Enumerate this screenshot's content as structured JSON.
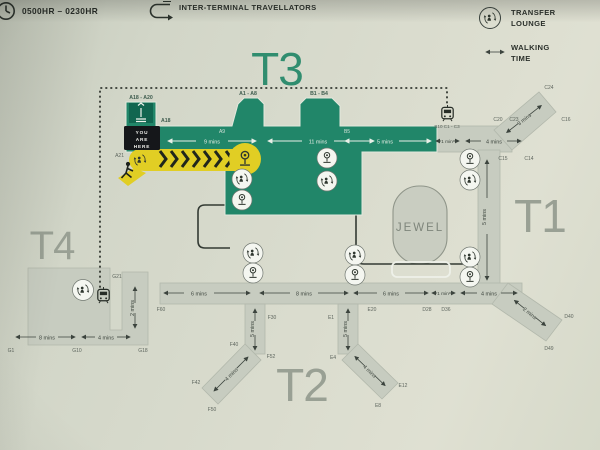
{
  "legend": {
    "operating_hours": "0500HR – 0230HR",
    "travellators_label": "INTER-TERMINAL TRAVELLATORS",
    "transfer_line1": "TRANSFER",
    "transfer_line2": "LOUNGE",
    "walking_line1": "WALKING",
    "walking_line2": "TIME"
  },
  "terminals": {
    "t3": "T3",
    "t1": "T1",
    "t2": "T2",
    "t4": "T4",
    "jewel": "JEWEL"
  },
  "marker": {
    "line1": "YOU",
    "line2": "ARE",
    "line3": "HERE"
  },
  "times": {
    "t3_seg1": "9 mins",
    "t3_seg2": "11 mins",
    "t3_seg3": "5 mins",
    "t1_link": "1 min",
    "t1_top": "4 mins",
    "t1_diag": "3 mins",
    "t1_pier": "5 mins",
    "t2_seg1": "6 mins",
    "t2_seg2": "8 mins",
    "t2_seg3": "6 mins",
    "t1_low_link": "1 min",
    "t1_low": "4 mins",
    "t1_low_diag": "2 mins",
    "t2_branch_left": "5 mins",
    "t2_branch_right": "5 mins",
    "t2_diag_left": "4 mins",
    "t2_diag_right": "4 mins",
    "t4_seg1": "8 mins",
    "t4_seg2": "4 mins",
    "t4_link": "2 mins"
  },
  "gates": {
    "a18_a20": "A18 - A20",
    "a18": "A18",
    "a21": "A21",
    "a1_a8": "A1 - A8",
    "b1_b4": "B1 - B4",
    "a9": "A9",
    "b5": "B5",
    "b10_c1c3": "B10  C1 - C3",
    "c24": "C24",
    "c20": "C20",
    "c23": "C23",
    "c16": "C16",
    "c15": "C15",
    "c14": "C14",
    "d28": "D28",
    "d36": "D36",
    "d40": "D40",
    "d49": "D49",
    "f60": "F60",
    "f30": "F30",
    "f40": "F40",
    "f52": "F52",
    "f42": "F42",
    "f50": "F50",
    "e1": "E1",
    "e20": "E20",
    "e4": "E4",
    "e12": "E12",
    "e8": "E8",
    "g1": "G1",
    "g10": "G10",
    "g18": "G18",
    "g21": "G21"
  },
  "colors": {
    "terminal_green": "#1d8769",
    "highlight_yellow": "#e2ce1b",
    "corridor_gray": "#c7ccbf",
    "label_gray": "#99a094"
  }
}
